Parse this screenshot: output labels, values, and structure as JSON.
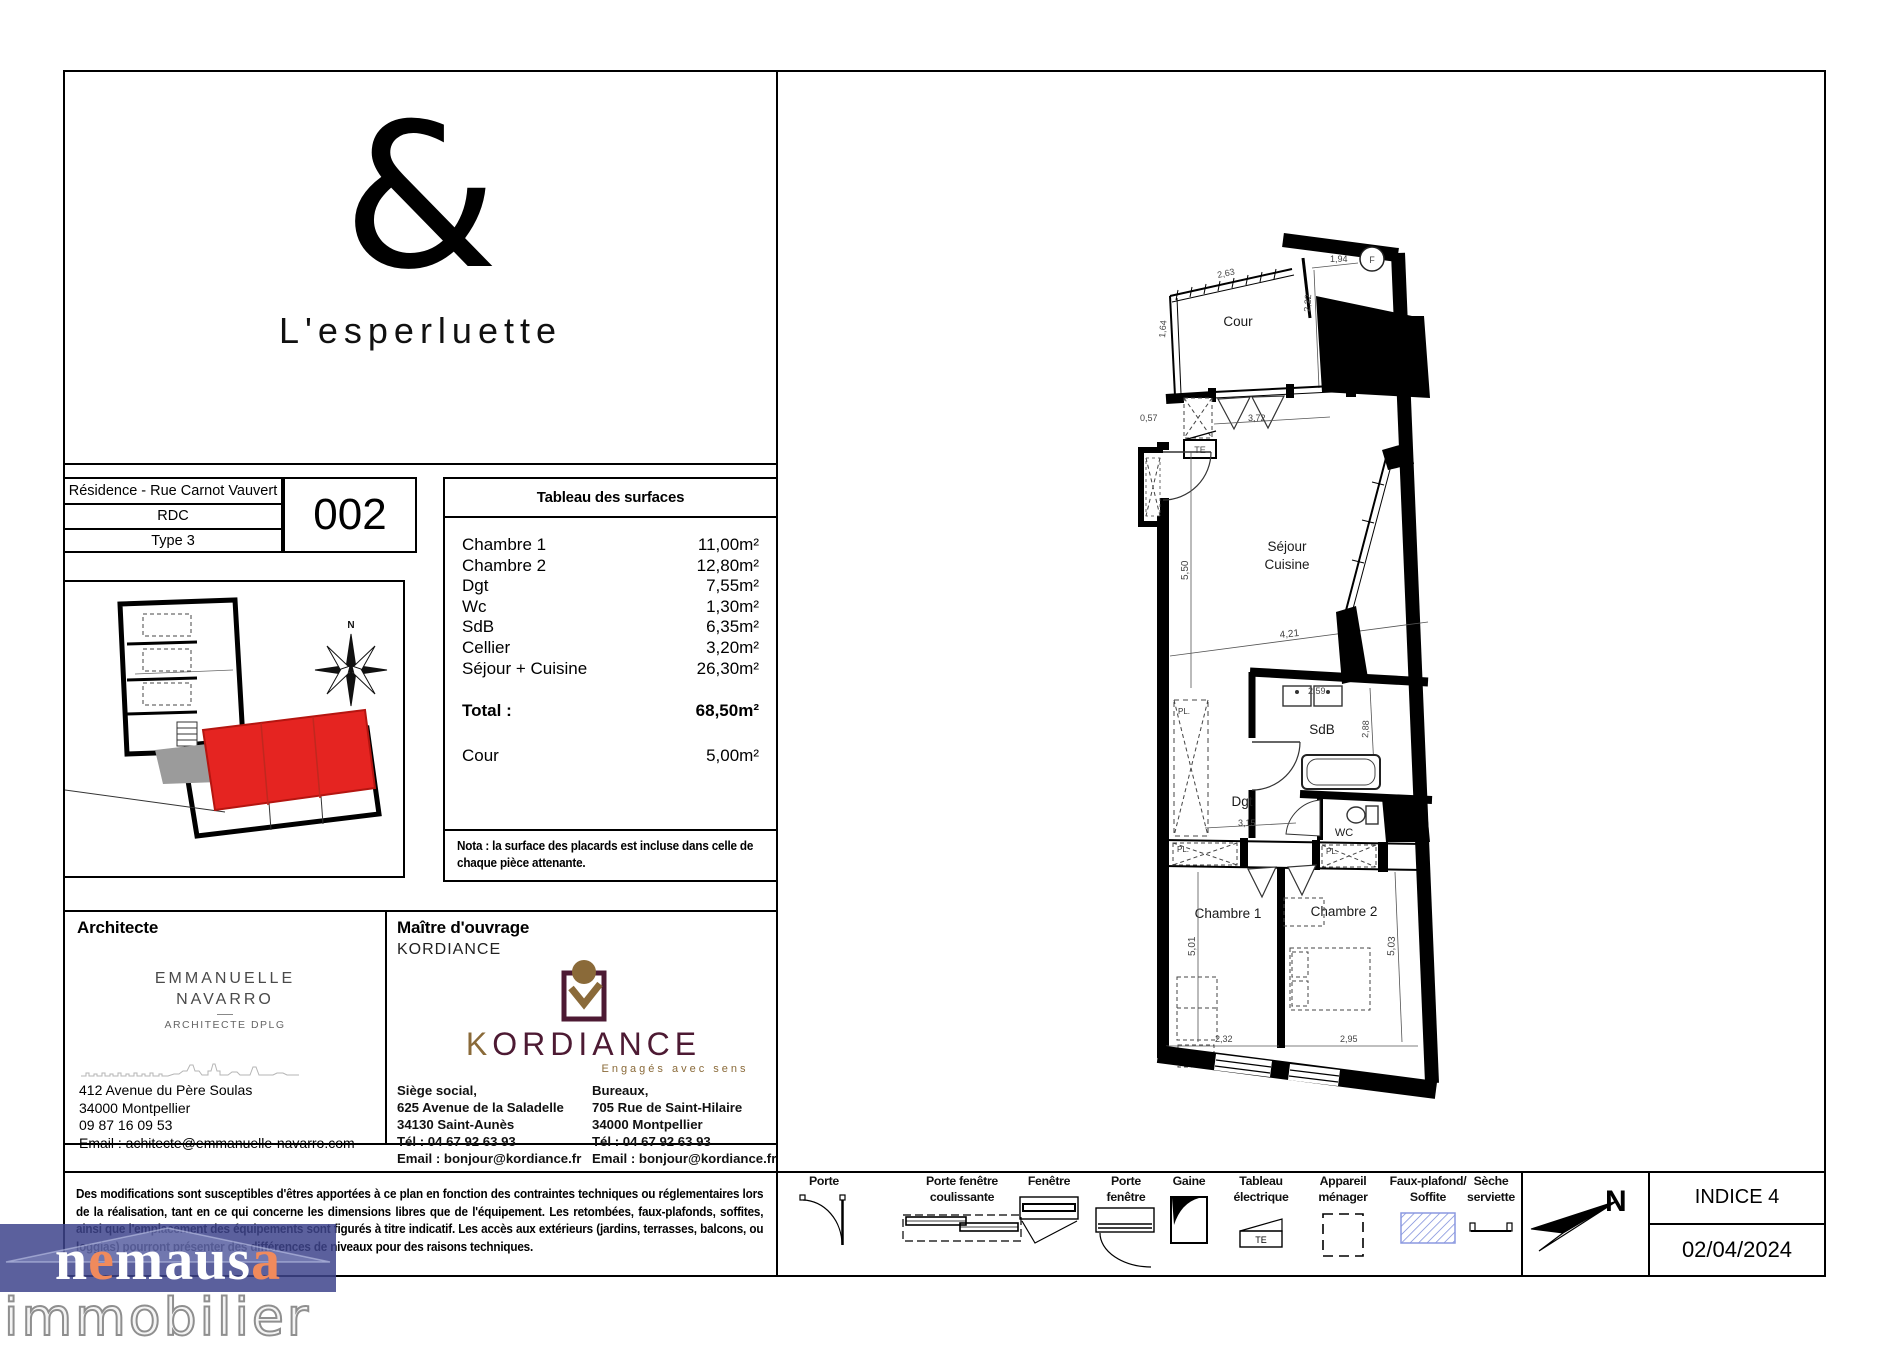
{
  "branding": {
    "ampersand": "&",
    "residence_name": "L'esperluette"
  },
  "title_block": {
    "residence": "Résidence - Rue Carnot Vauvert",
    "floor": "RDC",
    "type": "Type 3",
    "unit_number": "002"
  },
  "surface_table": {
    "title": "Tableau des surfaces",
    "rows": [
      {
        "label": "Chambre 1",
        "value": "11,00m²"
      },
      {
        "label": "Chambre 2",
        "value": "12,80m²"
      },
      {
        "label": "Dgt",
        "value": "7,55m²"
      },
      {
        "label": "Wc",
        "value": "1,30m²"
      },
      {
        "label": "SdB",
        "value": "6,35m²"
      },
      {
        "label": "Cellier",
        "value": "3,20m²"
      },
      {
        "label": "Séjour + Cuisine",
        "value": "26,30m²"
      }
    ],
    "total_label": "Total :",
    "total_value": "68,50m²",
    "cour_label": "Cour",
    "cour_value": "5,00m²",
    "nota": "Nota : la surface des placards est incluse dans celle de chaque pièce attenante."
  },
  "architect": {
    "heading": "Architecte",
    "name_line1": "EMMANUELLE",
    "name_line2": "NAVARRO",
    "title": "ARCHITECTE DPLG",
    "address1": "412 Avenue du Père Soulas",
    "address2": "34000 Montpellier",
    "phone": "09 87 16 09 53",
    "email": "Email : achitecte@emmanuelle-navarro.com"
  },
  "owner": {
    "heading": "Maître d'ouvrage",
    "name": "KORDIANCE",
    "logo_k": "K",
    "logo_rest": "ORDIANCE",
    "tagline": "Engagés avec sens",
    "siege": [
      "Siège social,",
      "625 Avenue de la Saladelle",
      "34130 Saint-Aunès",
      "Tél : 04 67 92 63 93",
      "Email : bonjour@kordiance.fr"
    ],
    "bureaux": [
      "Bureaux,",
      "705 Rue de Saint-Hilaire",
      "34000 Montpellier",
      "Tél : 04 67 92 63 93",
      "Email : bonjour@kordiance.fr"
    ]
  },
  "disclaimer": "Des modifications sont susceptibles d'êtres apportées à ce plan en fonction des contraintes techniques ou réglementaires lors de la réalisation, tant en ce qui concerne les dimensions libres que de l'équipement. Les retombées, faux-plafonds, soffites, ainsi que l'emplacement des équipements sont figurés à titre indicatif. Les accès aux extérieurs (jardins, terrasses, balcons, ou loggias) pourront présenter des différences de niveaux pour des raisons techniques.",
  "legend": {
    "items": [
      {
        "label1": "Porte",
        "label2": ""
      },
      {
        "label1": "Porte fenêtre",
        "label2": "coulissante"
      },
      {
        "label1": "Fenêtre",
        "label2": ""
      },
      {
        "label1": "Porte",
        "label2": "fenêtre"
      },
      {
        "label1": "Gaine",
        "label2": ""
      },
      {
        "label1": "Tableau",
        "label2": "électrique"
      },
      {
        "label1": "Appareil",
        "label2": "ménager"
      },
      {
        "label1": "Faux-plafond/",
        "label2": "Soffite"
      },
      {
        "label1": "Sèche",
        "label2": "serviette"
      }
    ],
    "te_symbol": "TE"
  },
  "revision": {
    "north_label": "N",
    "indice": "INDICE 4",
    "date": "02/04/2024"
  },
  "site_plan": {
    "north_label": "N"
  },
  "floor_plan": {
    "rooms": {
      "cour": "Cour",
      "sejour_line1": "Séjour",
      "sejour_line2": "Cuisine",
      "sdb": "SdB",
      "dgt": "Dgt",
      "wc": "WC",
      "chambre1": "Chambre 1",
      "chambre2": "Chambre 2"
    },
    "markers": {
      "pl": "PL.",
      "te": "TE",
      "f": "F"
    },
    "dims": {
      "cour_top": "2,63",
      "cour_left": "1,64",
      "froom_w": "1,94",
      "froom_h": "2,22",
      "offset": "0,57",
      "bay": "3,72",
      "sejour_h": "5,50",
      "sejour_w": "4,21",
      "sdb_w": "2,59",
      "sdb_h": "2,88",
      "dgt_w": "3,15",
      "ch1_h": "5,01",
      "ch2_h": "5,03",
      "ch1_w": "2,32",
      "ch2_w": "2,95"
    }
  },
  "watermark": {
    "p1": "n",
    "p2": "e",
    "p3": "maus",
    "p4": "a",
    "line2": "immobilier"
  },
  "colors": {
    "unit_red": "#e52421",
    "kordiance_maroon": "#4d1a33",
    "kordiance_gold": "#8a6a39",
    "soffit_blue": "#6d7fd6",
    "watermark_blue": "rgba(62,68,140,0.85)",
    "watermark_orange": "#f08a5c"
  }
}
